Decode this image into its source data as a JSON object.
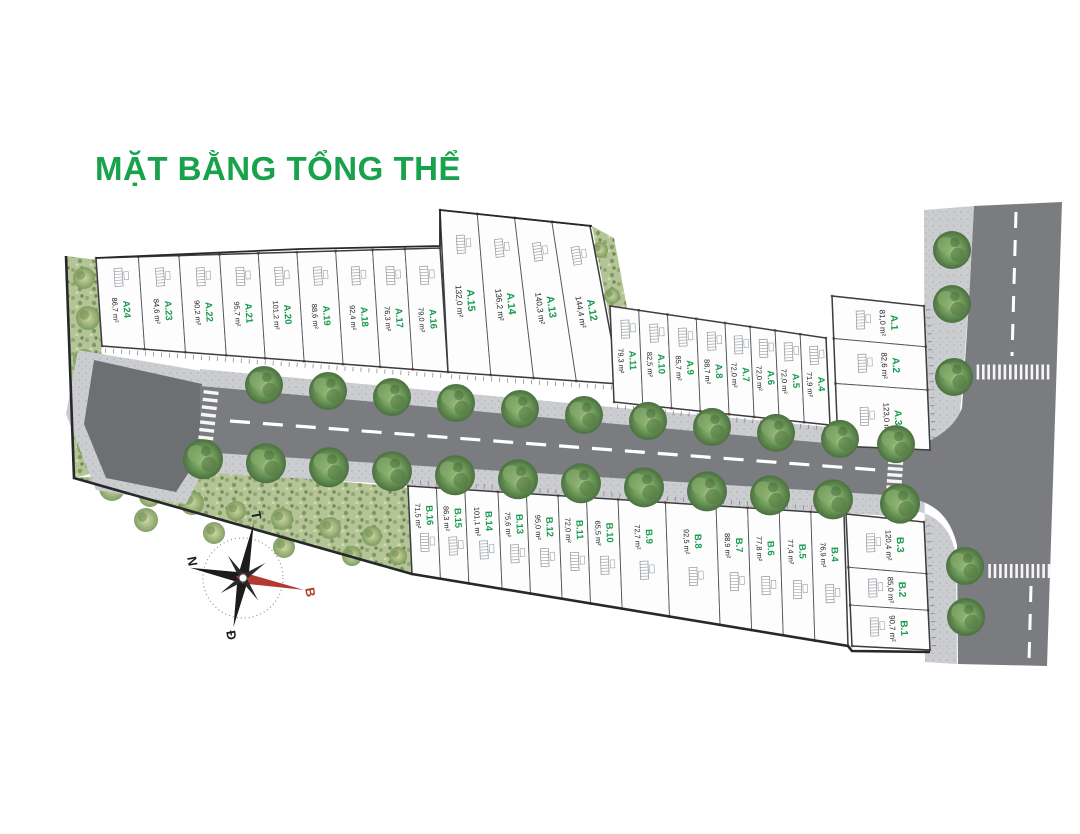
{
  "title": "MẶT BẰNG TỔNG THỂ",
  "compass": {
    "top": "T",
    "left": "N",
    "bottom": "Đ",
    "right": "B"
  },
  "colors": {
    "title_green": "#17a24b",
    "lot_green": "#169b4f",
    "area_black": "#222222",
    "road_gray": "#7a7c7f",
    "bulb_gray": "#6d7073",
    "marker_red": "#b0493f",
    "compass_red": "#b23b30",
    "grass_green": "#b5c496",
    "sidewalk_gray": "#cccdd0"
  },
  "blocks": {
    "a_outer": [
      "A24",
      "A.23",
      "A.22",
      "A.21",
      "A.20",
      "A.19",
      "A.18",
      "A.17",
      "A.16"
    ],
    "a_deep": [
      "A.15",
      "A.14",
      "A.13",
      "A.12"
    ],
    "a_inner": [
      "A.11",
      "A.10",
      "A.9",
      "A.8",
      "A.7",
      "A.6",
      "A.5",
      "A.4"
    ],
    "a_corner": [
      "A.1",
      "A.2",
      "A.3"
    ],
    "b_main": [
      "B.16",
      "B.15",
      "B.14",
      "B.13",
      "B.12",
      "B.11",
      "B.10",
      "B.9",
      "B.8",
      "B.7",
      "B.6",
      "B.5",
      "B.4"
    ],
    "b_corner": [
      "B.3",
      "B.2",
      "B.1"
    ]
  },
  "lots": {
    "A24": "86,7 m²",
    "A.23": "84,6 m²",
    "A.22": "90,2 m²",
    "A.21": "95,7 m²",
    "A.20": "101,2 m²",
    "A.19": "88,6 m²",
    "A.18": "92,4 m²",
    "A.17": "76,3 m²",
    "A.16": "79,0 m²",
    "A.15": "132,0 m²",
    "A.14": "136,2 m²",
    "A.13": "140,3 m²",
    "A.12": "144,4 m²",
    "A.11": "79,3 m²",
    "A.10": "82,5 m²",
    "A.9": "85,7 m²",
    "A.8": "88,7 m²",
    "A.7": "72,0 m²",
    "A.6": "72,0 m²",
    "A.5": "72,0 m²",
    "A.4": "71,9 m²",
    "A.3": "123,0 m²",
    "A.2": "82,6 m²",
    "A.1": "81,0 m²",
    "B.16": "71,5 m²",
    "B.15": "86,3 m²",
    "B.14": "101,1 m²",
    "B.13": "75,6 m²",
    "B.12": "95,0 m²",
    "B.11": "72,0 m²",
    "B.10": "65,5 m²",
    "B.9": "72,7 m²",
    "B.8": "92,5 m²",
    "B.7": "88,9 m²",
    "B.6": "77,8 m²",
    "B.5": "77,4 m²",
    "B.4": "76,9 m²",
    "B.3": "120,4 m²",
    "B.2": "85,0 m²",
    "B.1": "90,7 m²"
  }
}
